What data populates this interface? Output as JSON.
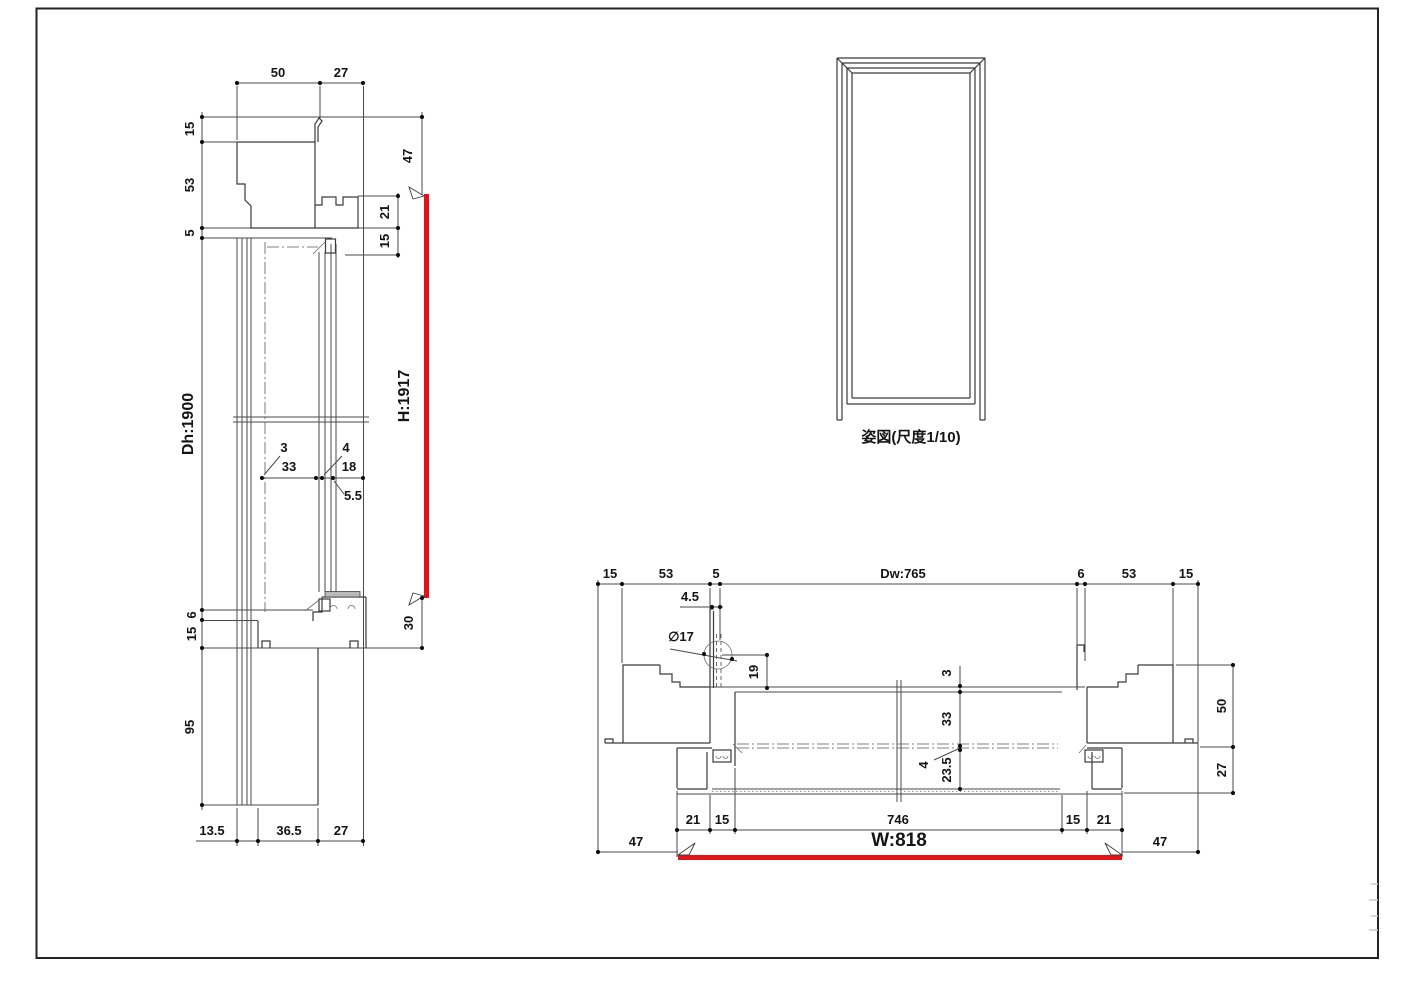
{
  "colors": {
    "highlight_red": "#e21317",
    "line": "#3a3a3a"
  },
  "vs": {
    "d50": "50",
    "d27": "27",
    "d15t": "15",
    "d53": "53",
    "d5": "5",
    "dh": "Dh:1900",
    "d6": "6",
    "d15b": "15",
    "d95": "95",
    "d47": "47",
    "d21": "21",
    "d15r": "15",
    "h": "H:1917",
    "d30": "30",
    "d3": "3",
    "d33": "33",
    "d4": "4",
    "d18": "18",
    "d55": "5.5",
    "d135": "13.5",
    "d365": "36.5",
    "d27b": "27"
  },
  "el": {
    "caption": "姿図(尺度1/10)"
  },
  "hs": {
    "d15l": "15",
    "d53l": "53",
    "d5": "5",
    "d45": "4.5",
    "dw": "Dw:765",
    "d6": "6",
    "d53r": "53",
    "d15r": "15",
    "dia": "∅17",
    "d19": "19",
    "d3": "3",
    "d33": "33",
    "d4": "4",
    "d235": "23.5",
    "d50": "50",
    "d27": "27",
    "b21l": "21",
    "b15l": "15",
    "b746": "746",
    "b15r": "15",
    "b21r": "21",
    "f47l": "47",
    "w": "W:818",
    "f47r": "47"
  }
}
